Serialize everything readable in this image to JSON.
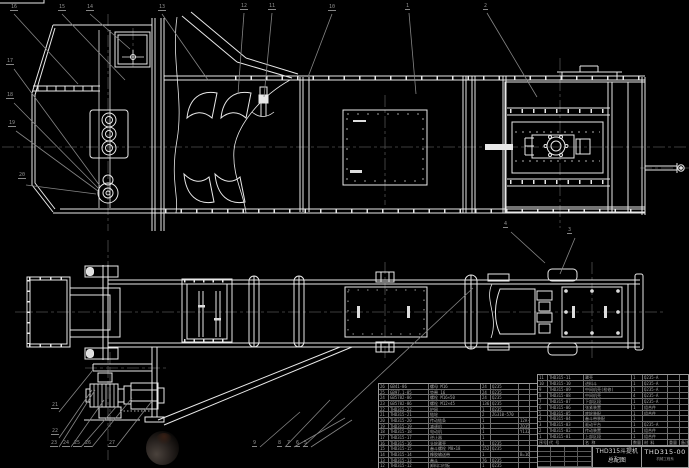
{
  "drawing": {
    "product": "THD315斗提机",
    "sheet_title": "总配图",
    "drawing_no": "THD315-00",
    "org": "机械工程系"
  },
  "colors": {
    "background": "#000000",
    "main_line": "#e8e8e8",
    "leader_line": "#858585",
    "center_line": "#4f4f4f",
    "table_line": "#6f6f6f",
    "table_text": "#a8a8a8"
  },
  "balloons": [
    {
      "x": 10,
      "y": 4,
      "n": "16"
    },
    {
      "x": 58,
      "y": 4,
      "n": "15"
    },
    {
      "x": 86,
      "y": 4,
      "n": "14"
    },
    {
      "x": 158,
      "y": 4,
      "n": "13"
    },
    {
      "x": 240,
      "y": 3,
      "n": "12"
    },
    {
      "x": 268,
      "y": 3,
      "n": "11"
    },
    {
      "x": 328,
      "y": 4,
      "n": "10"
    },
    {
      "x": 405,
      "y": 3,
      "n": "1"
    },
    {
      "x": 483,
      "y": 3,
      "n": "2"
    },
    {
      "x": 6,
      "y": 58,
      "n": "17"
    },
    {
      "x": 6,
      "y": 92,
      "n": "18"
    },
    {
      "x": 8,
      "y": 120,
      "n": "19"
    },
    {
      "x": 18,
      "y": 172,
      "n": "20"
    },
    {
      "x": 51,
      "y": 402,
      "n": "21"
    },
    {
      "x": 51,
      "y": 428,
      "n": "22"
    },
    {
      "x": 50,
      "y": 440,
      "n": "23"
    },
    {
      "x": 62,
      "y": 440,
      "n": "24"
    },
    {
      "x": 73,
      "y": 440,
      "n": "25"
    },
    {
      "x": 84,
      "y": 440,
      "n": "26"
    },
    {
      "x": 108,
      "y": 440,
      "n": "27"
    },
    {
      "x": 252,
      "y": 440,
      "n": "9"
    },
    {
      "x": 277,
      "y": 440,
      "n": "8"
    },
    {
      "x": 286,
      "y": 440,
      "n": "7"
    },
    {
      "x": 295,
      "y": 440,
      "n": "6"
    },
    {
      "x": 303,
      "y": 440,
      "n": "5"
    },
    {
      "x": 503,
      "y": 221,
      "n": "4"
    },
    {
      "x": 567,
      "y": 227,
      "n": "3"
    }
  ],
  "tables": {
    "parts_list_left": {
      "rows": [
        [
          "26",
          "GB41-86",
          "螺母 M16",
          "24",
          "Q235",
          "",
          ""
        ],
        [
          "25",
          "GB97.1-85",
          "垫圈 16",
          "24",
          "Q235",
          "",
          ""
        ],
        [
          "24",
          "GB5782-86",
          "螺栓 M16×50",
          "24",
          "Q235",
          "",
          ""
        ],
        [
          "23",
          "GB5782-86",
          "螺栓 M12×45",
          "136",
          "Q235",
          "",
          ""
        ],
        [
          "22",
          "THD315-22",
          "护网",
          "1",
          "Q235",
          "",
          ""
        ],
        [
          "21",
          "THD315-21",
          "链轮",
          "2",
          "ZG310-570",
          "",
          ""
        ],
        [
          "20",
          "THD315-20",
          "传动链条",
          "1",
          "",
          "12A-1",
          ""
        ],
        [
          "19",
          "THD315-19",
          "减速机",
          "1",
          "",
          "ZQ350-2",
          ""
        ],
        [
          "18",
          "THD315-18",
          "电动机",
          "1",
          "",
          "Y132M-4",
          ""
        ],
        [
          "17",
          "THD315-17",
          "逆止器",
          "1",
          "",
          "",
          ""
        ],
        [
          "16",
          "THD315-16",
          "头轮罩壳",
          "1",
          "Q235",
          "",
          ""
        ],
        [
          "15",
          "THD315-15",
          "畚斗螺栓 M8×18",
          "152",
          "Q235",
          "",
          ""
        ],
        [
          "14",
          "THD315-14",
          "橡胶输送带",
          "1",
          "",
          "B=160",
          ""
        ],
        [
          "13",
          "THD315-13",
          "畚斗",
          "76",
          "Q235",
          "",
          ""
        ],
        [
          "12",
          "THD315-12",
          "卸料口衬板",
          "1",
          "Q235",
          "",
          ""
        ]
      ]
    },
    "parts_list_right": {
      "rows": [
        [
          "11",
          "THD315-11",
          "罩壳",
          "1",
          "Q235-A",
          "",
          ""
        ],
        [
          "10",
          "THD315-10",
          "进料斗",
          "1",
          "Q235-A",
          "",
          ""
        ],
        [
          "9",
          "THD315-09",
          "中间机壳(检修)",
          "1",
          "Q235-A",
          "",
          ""
        ],
        [
          "8",
          "THD315-08",
          "中间机壳",
          "4",
          "Q235-A",
          "",
          ""
        ],
        [
          "7",
          "THD315-07",
          "下部区段",
          "1",
          "Q235-A",
          "",
          ""
        ],
        [
          "6",
          "THD315-06",
          "张紧装置",
          "1",
          "组合件",
          "",
          ""
        ],
        [
          "5",
          "THD315-05",
          "底轮装配",
          "1",
          "组合件",
          "",
          ""
        ],
        [
          "4",
          "THD315-04",
          "畚斗带装配",
          "1",
          "",
          "",
          ""
        ],
        [
          "3",
          "THD315-03",
          "驱动平台",
          "1",
          "Q235-A",
          "",
          ""
        ],
        [
          "2",
          "THD315-02",
          "传动装置",
          "1",
          "组合件",
          "",
          ""
        ],
        [
          "1",
          "THD315-01",
          "上部区段",
          "1",
          "组合件",
          "",
          ""
        ],
        [
          "序号",
          "代 号",
          "名 称",
          "数量",
          "材 料",
          "重量",
          "备注"
        ]
      ]
    }
  }
}
